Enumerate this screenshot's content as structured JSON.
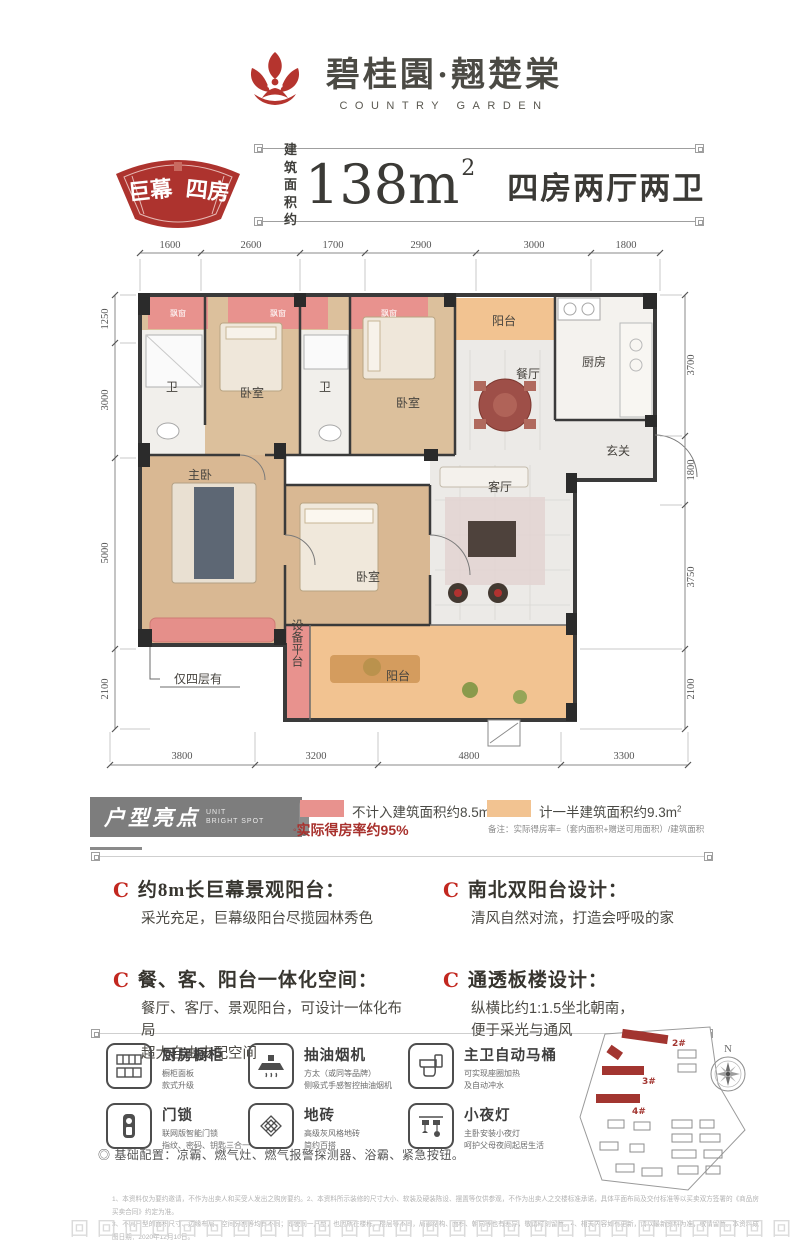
{
  "brand": {
    "name_cn": "碧桂園·翹楚棠",
    "name_en": "COUNTRY GARDEN"
  },
  "header": {
    "badge_word1": "巨幕",
    "badge_word2": "四房",
    "area_prefix_line1": "建 筑",
    "area_prefix_line2": "面积约",
    "area_value": "138m",
    "area_sup": "2",
    "rooms_desc": "四房两厅两卫"
  },
  "floorplan": {
    "dims_top": [
      "1600",
      "2600",
      "1700",
      "2900",
      "3000",
      "1800"
    ],
    "dims_left": [
      "1250",
      "3000",
      "5000",
      "2100"
    ],
    "dims_right": [
      "3700",
      "1800",
      "3750",
      "2100"
    ],
    "dims_bottom": [
      "3800",
      "3200",
      "4800",
      "3300"
    ],
    "labels": {
      "bath1": "卫",
      "bed1": "卧室",
      "bath2": "卫",
      "bed2": "卧室",
      "dining": "餐厅",
      "kitchen": "厨房",
      "hall": "玄关",
      "living": "客厅",
      "master": "主卧",
      "bed3": "卧室",
      "balcony_top": "阳台",
      "balcony_bottom": "阳台",
      "equipment": "设备平台",
      "bay1": "飘窗",
      "bay2": "飘窗",
      "bay3": "飘窗",
      "floor_note": "仅四层有"
    }
  },
  "legend": {
    "pink_label": "不计入建筑面积约8.5m",
    "pink_sup": "2",
    "orange_label": "计一半建筑面积约9.3m",
    "orange_sup": "2",
    "rate_bullet": "◦",
    "rate_text": "实际得房率约95%",
    "note": "备注：实际得房率=（套内面积+赠送可用面积）/建筑面积"
  },
  "highlights": {
    "title_cn": "户型亮点",
    "title_en_line1": "UNIT",
    "title_en_line2": "BRIGHT SPOT",
    "bullet": "C",
    "items": [
      {
        "title": "约8m长巨幕景观阳台：",
        "desc": "采光充足，巨幕级阳台尽揽园林秀色"
      },
      {
        "title": "餐、客、阳台一体化空间：",
        "desc": "餐厅、客厅、景观阳台，可设计一体化布局\n超大自由支配空间"
      },
      {
        "title": "南北双阳台设计：",
        "desc": "清风自然对流，打造会呼吸的家"
      },
      {
        "title": "通透板楼设计：",
        "desc": "纵横比约1:1.5坐北朝南，\n便于采光与通风"
      }
    ]
  },
  "features": {
    "items": [
      {
        "title": "厨房橱柜",
        "desc": "橱柜面板\n款式升级"
      },
      {
        "title": "抽油烟机",
        "desc": "方太（或同等品牌）\n侧吸式手感智控抽油烟机"
      },
      {
        "title": "主卫自动马桶",
        "desc": "可实现座圈加热\n及自动冲水"
      },
      {
        "title": "门锁",
        "desc": "联网版智能门锁\n指纹、密码、钥匙三合一"
      },
      {
        "title": "地砖",
        "desc": "高级灰风格地砖\n简约百搭"
      },
      {
        "title": "小夜灯",
        "desc": "主卧安装小夜灯\n呵护父母夜间起居生活"
      }
    ],
    "base_config": "◎ 基础配置：凉霸、燃气灶、燃气报警探测器、浴霸、紧急按钮。"
  },
  "sitemap": {
    "building_labels": [
      "2#",
      "3#",
      "4#"
    ],
    "compass_n": "N"
  },
  "footer": {
    "disclaimer_line1": "1、本资料仅为要约邀请，不作为出卖人和买受人发出之购房要约。2、本资料所示装修的尺寸大小、软装及硬装陈设、摆置等仅供参观，不作为出卖人之交楼标准承诺，具体平面布局及交付标准等以买卖双方签署的《商品房买卖合同》约定为准。",
    "disclaimer_line2": "3、不同户型的面积尺寸、边缘布局、空间分割等均有不同；即使同一户型，也因所在楼栋、楼层等不同，局部结构、面积、朝向等也有差异，敬请时刻留意。4、相关内容如有更新，请以最新资料为准，敬请留意。本资料成图日期：2020年12月10日。",
    "border_pattern": "回回回回回回回回回回回回回回回回回回回回回回回回回回回回"
  }
}
